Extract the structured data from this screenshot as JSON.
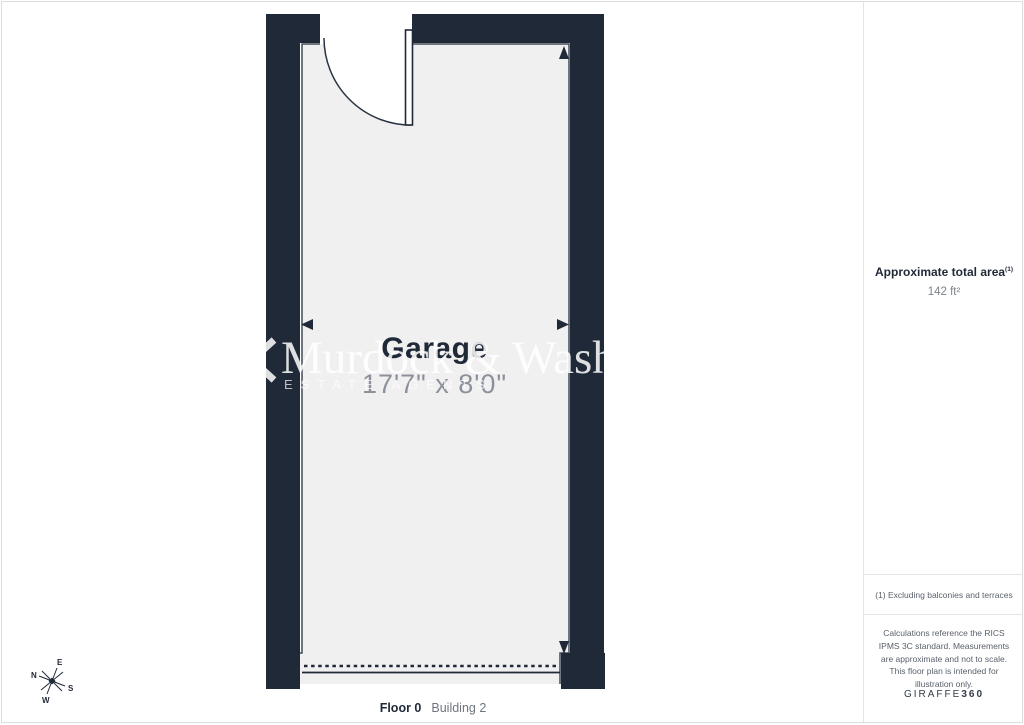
{
  "floor_plan": {
    "room_label": "Garage",
    "room_dimensions": "17'7\" x 8'0\"",
    "floor_label": "Floor 0",
    "building_label": "Building 2",
    "wall_color": "#202938",
    "floor_color": "#f0f0f1"
  },
  "watermark": {
    "name": "Murdock & Wash",
    "subtitle": "ESTATE AGENTS"
  },
  "compass": {
    "n": "N",
    "e": "E",
    "s": "S",
    "w": "W"
  },
  "sidebar": {
    "area_title": "Approximate total area",
    "area_footnote_marker": "(1)",
    "area_value": "142 ft²",
    "footnote": "(1) Excluding balconies and terraces",
    "disclaimer": "Calculations reference the RICS IPMS 3C standard. Measurements are approximate and not to scale. This floor plan is intended for illustration only.",
    "brand_regular": "GIRAFFE",
    "brand_bold": "360"
  }
}
